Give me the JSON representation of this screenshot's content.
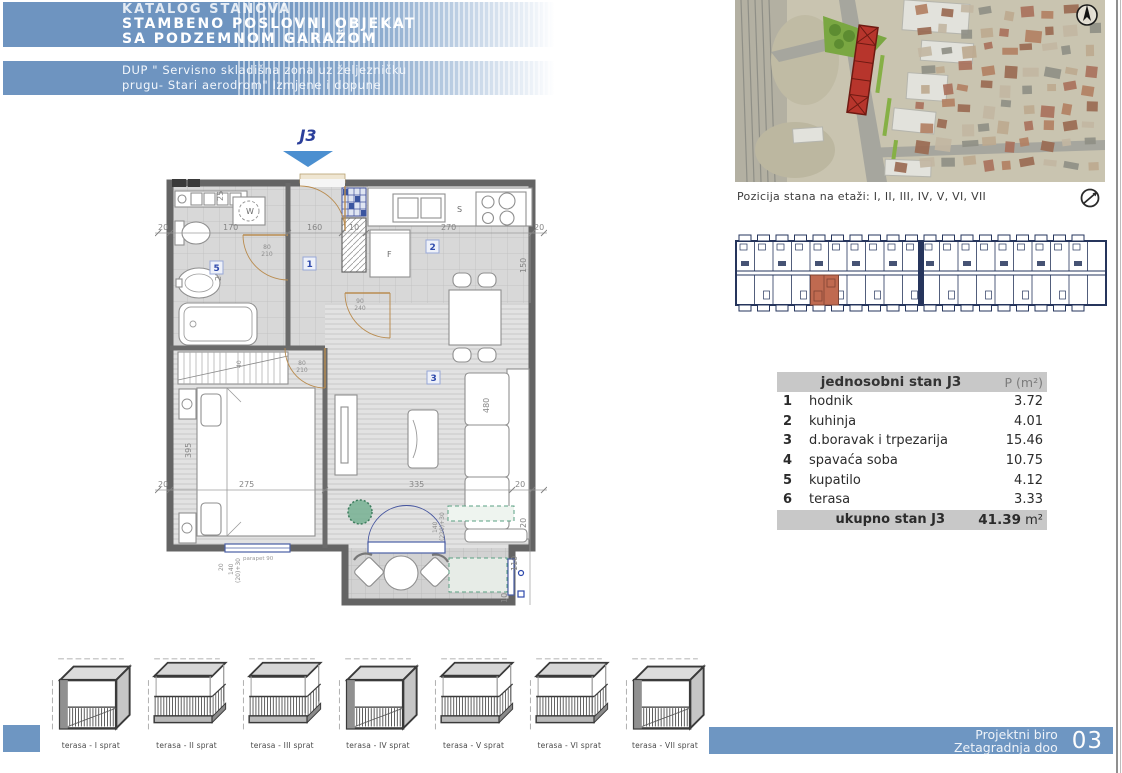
{
  "header": {
    "line1": "KATALOG STANOVA",
    "line2": "STAMBENO POSLOVNI OBJEKAT",
    "line3": "SA PODZEMNOM GARAŽOM",
    "sub1": "DUP \" Servisno skladišna zona uz željezničku",
    "sub2": "prugu- Stari aerodrom\" Izmjene i dopune"
  },
  "plan": {
    "unit_title": "J3",
    "labels": {
      "room1": "1",
      "room2": "2",
      "room3": "3",
      "room5": "5",
      "washer": "W",
      "fridge": "F",
      "sink": "S"
    },
    "dims": {
      "t0": "20",
      "t1": "170",
      "t2": "160",
      "t3": "10",
      "t4": "270",
      "t5": "20",
      "b0": "20",
      "b1": "275",
      "b2": "335",
      "b3": "20",
      "v25": "25",
      "v150": "150",
      "v275": "275",
      "v395": "395",
      "v480": "480",
      "v110": "110",
      "v10": "10",
      "v20": "20",
      "v40": "40",
      "d80": "80",
      "d210": "210",
      "d90": "90",
      "d240": "240",
      "dt1": "140",
      "dt2": "(220)+30",
      "db1": "140",
      "db2": "(20)+30",
      "parapet": "parapet 90"
    }
  },
  "map": {
    "caption": "Pozicija stana na etaži: I, II, III, IV, V, VI, VII"
  },
  "table": {
    "title": "jednosobni stan J3",
    "area_header": "P (m²)",
    "rows": [
      {
        "num": "1",
        "name": "hodnik",
        "area": "3.72"
      },
      {
        "num": "2",
        "name": "kuhinja",
        "area": "4.01"
      },
      {
        "num": "3",
        "name": "d.boravak i trpezarija",
        "area": "15.46"
      },
      {
        "num": "4",
        "name": "spavaća soba",
        "area": "10.75"
      },
      {
        "num": "5",
        "name": "kupatilo",
        "area": "4.12"
      },
      {
        "num": "6",
        "name": "terasa",
        "area": "3.33"
      }
    ],
    "total_label": "ukupno stan J3",
    "total_value": "41.39",
    "total_unit": "m²"
  },
  "terraces": {
    "items": [
      {
        "label": "terasa - I sprat",
        "type": "closed"
      },
      {
        "label": "terasa - II sprat",
        "type": "open"
      },
      {
        "label": "terasa - III sprat",
        "type": "open"
      },
      {
        "label": "terasa - IV sprat",
        "type": "closed"
      },
      {
        "label": "terasa - V sprat",
        "type": "open"
      },
      {
        "label": "terasa - VI sprat",
        "type": "open"
      },
      {
        "label": "terasa - VII sprat",
        "type": "closed"
      }
    ]
  },
  "footer": {
    "line1": "Projektni biro",
    "line2": "Zetagradnja doo",
    "page_number": "03"
  }
}
